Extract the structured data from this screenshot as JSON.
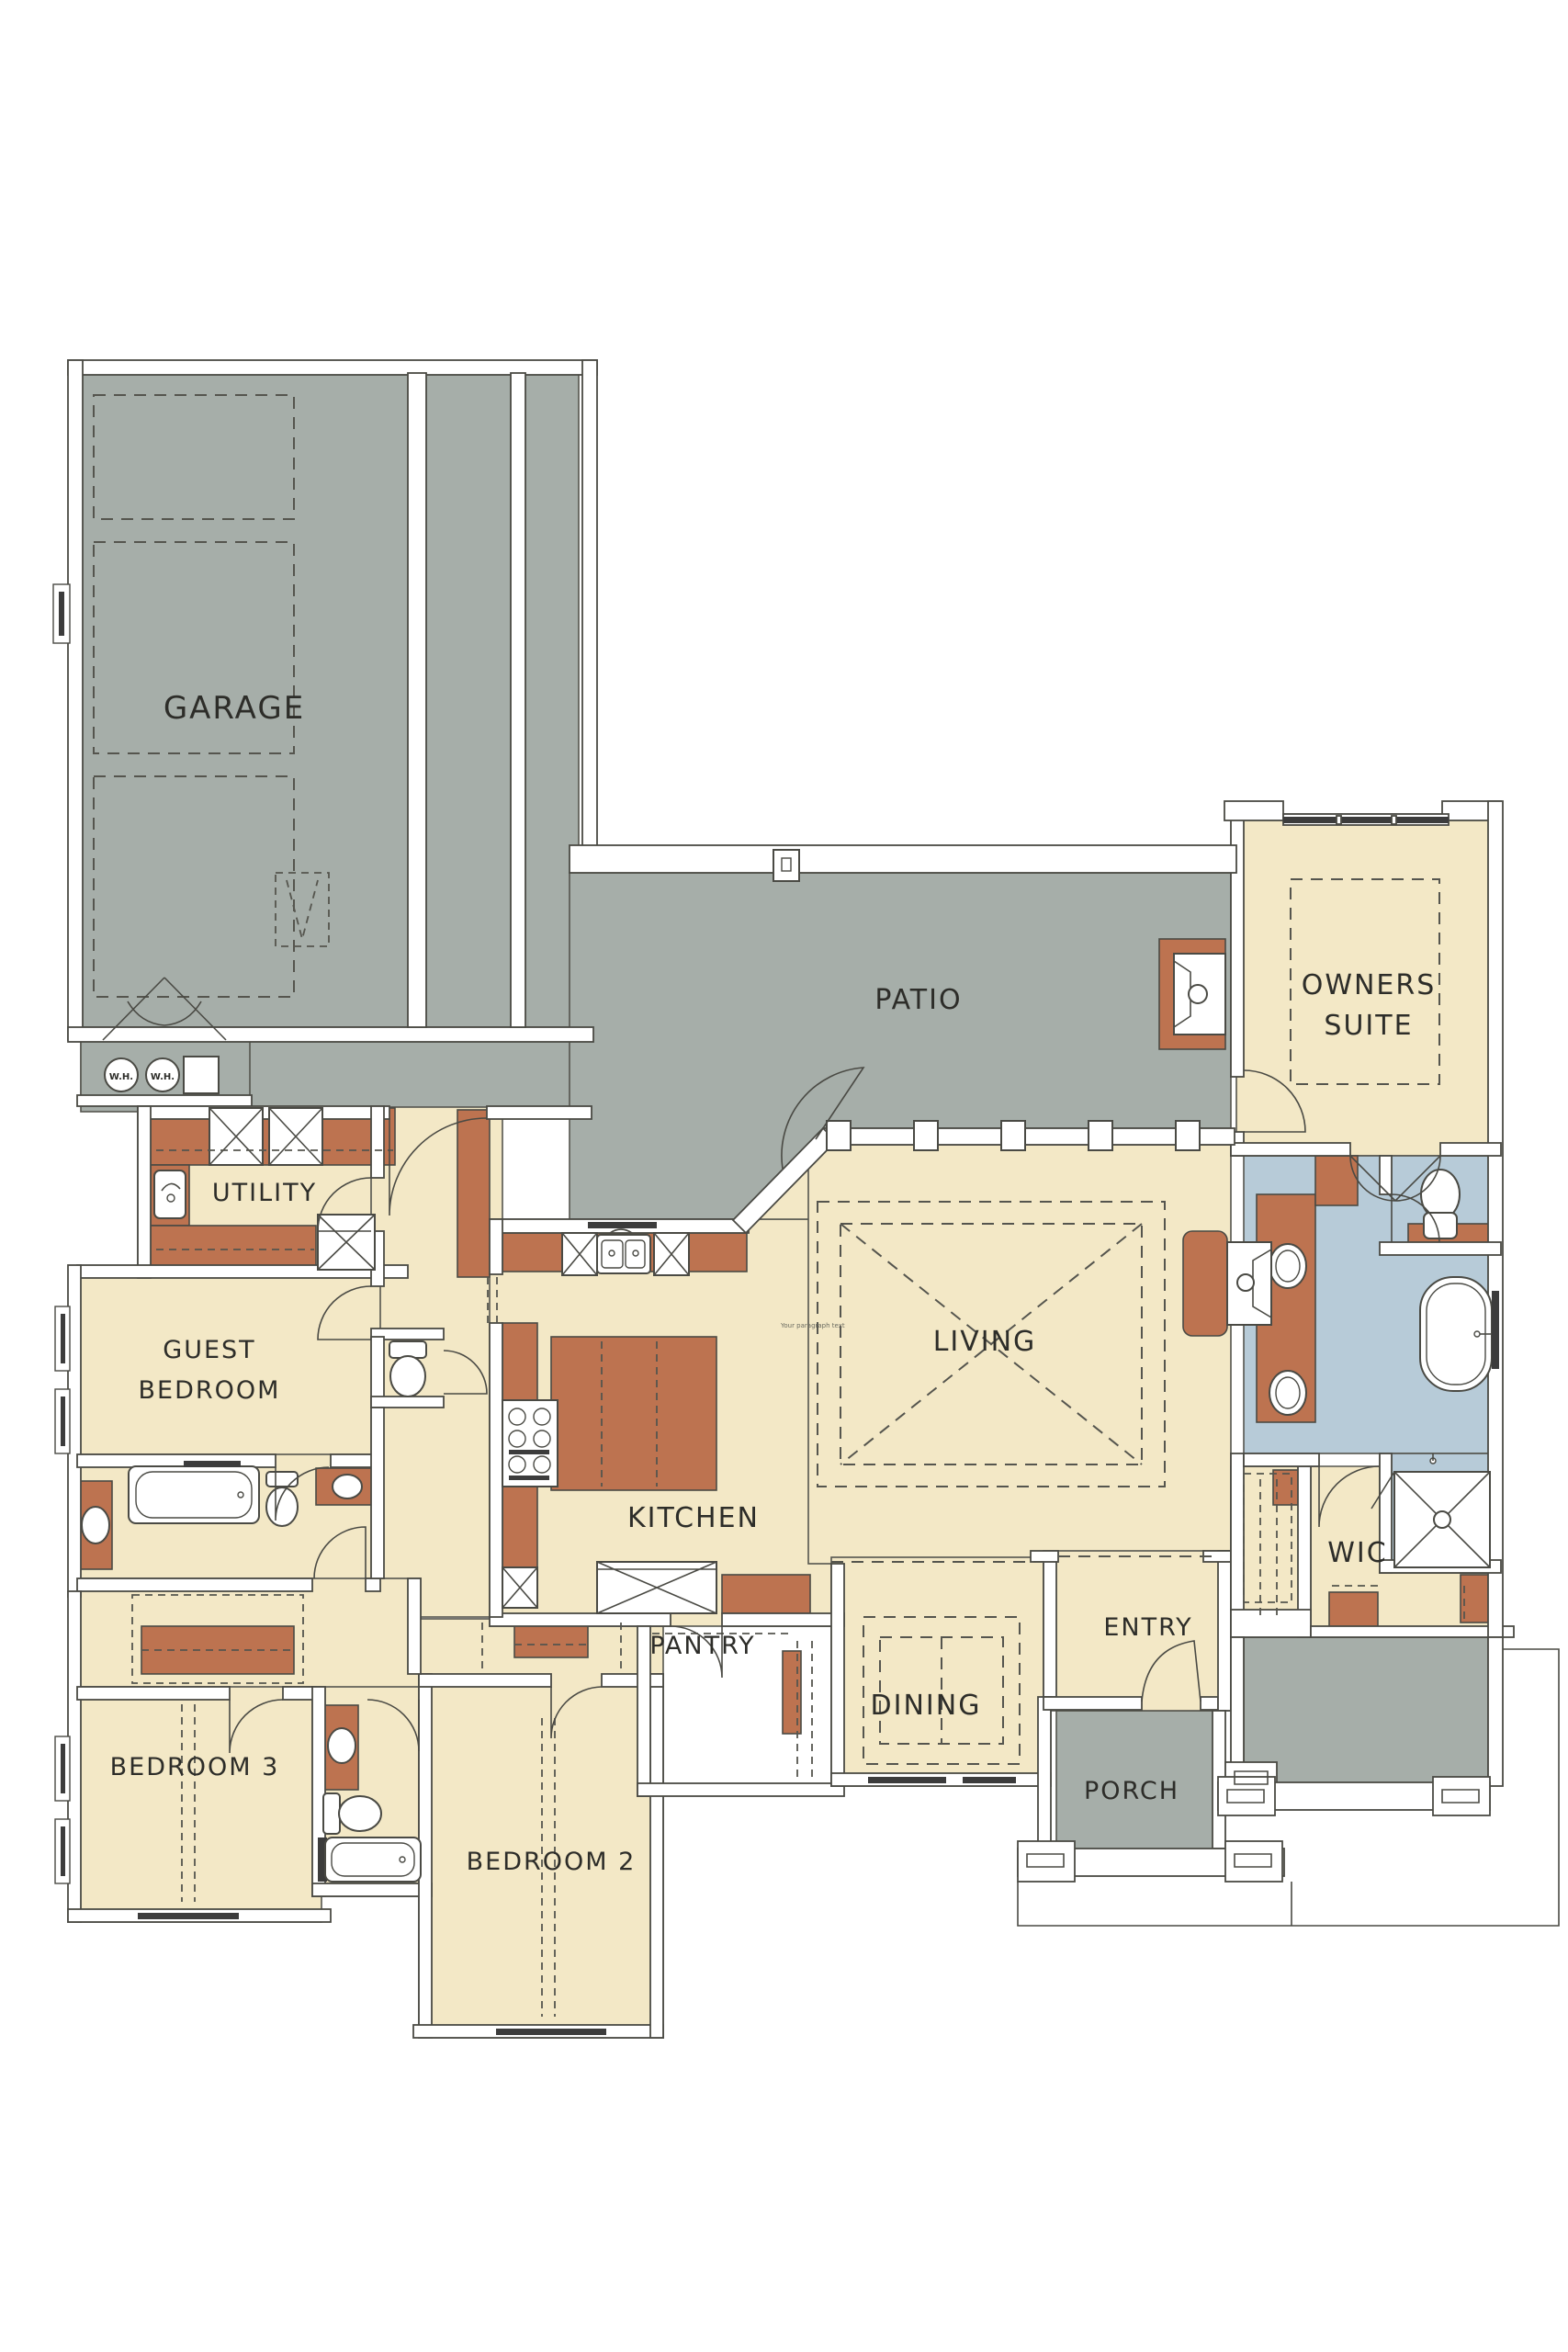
{
  "page": {
    "title": "House Floor Plan"
  },
  "colors": {
    "gray": "#a6aea9",
    "cream": "#f3e8c6",
    "brown": "#bd7350",
    "blue": "#b7cbd8",
    "ink": "#2d2d29",
    "wall_line": "#4a4a44",
    "background": "#ffffff"
  },
  "rooms": {
    "garage": {
      "label": "GARAGE"
    },
    "patio": {
      "label": "PATIO"
    },
    "owners_suite": {
      "label_line1": "OWNERS",
      "label_line2": "SUITE"
    },
    "utility": {
      "label": "UTILITY"
    },
    "guest_bedroom": {
      "label_line1": "GUEST",
      "label_line2": "BEDROOM"
    },
    "living": {
      "label": "LIVING"
    },
    "kitchen": {
      "label": "KITCHEN"
    },
    "wic": {
      "label": "WIC"
    },
    "pantry": {
      "label": "PANTRY"
    },
    "dining": {
      "label": "DINING"
    },
    "entry": {
      "label": "ENTRY"
    },
    "porch": {
      "label": "PORCH"
    },
    "bedroom3": {
      "label": "BEDROOM 3"
    },
    "bedroom2": {
      "label": "BEDROOM 2"
    }
  },
  "equipment": {
    "water_heater_1": "W.H.",
    "water_heater_2": "W.H."
  },
  "watermark": "Your paragraph text"
}
